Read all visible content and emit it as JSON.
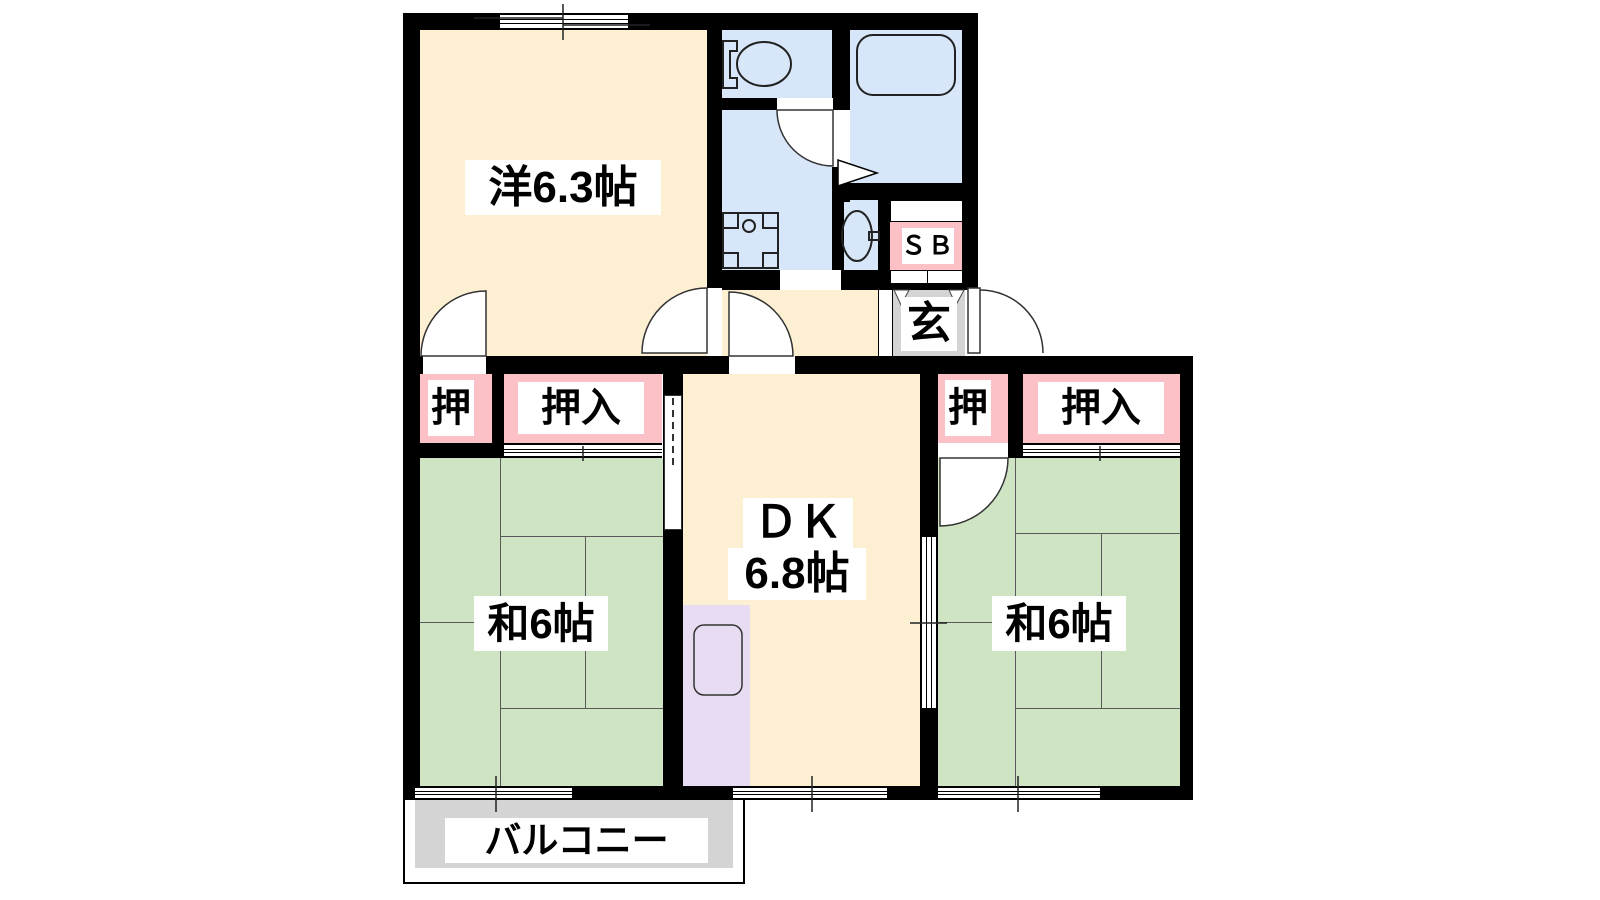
{
  "floorplan": {
    "type": "japanese-apartment-2dk",
    "rooms": {
      "western_room": {
        "label": "洋6.3帖",
        "color": "#FCEFD2"
      },
      "dining_kitchen": {
        "label_top": "ＤＫ",
        "label_bottom": "6.8帖",
        "color": "#FCEFD2"
      },
      "japanese_room_left": {
        "label": "和6帖",
        "color": "#CFE4C2"
      },
      "japanese_room_right": {
        "label": "和6帖",
        "color": "#CFE4C2"
      },
      "balcony": {
        "label": "バルコニー",
        "color": "#D4D4D4"
      },
      "entrance": {
        "label": "玄",
        "color": "#D4D4D4"
      },
      "shoe_box": {
        "label": "ＳＢ",
        "color": "#FBC1C6"
      },
      "closet_compact_left": {
        "label": "押",
        "color": "#FBC1C6"
      },
      "closet_left": {
        "label": "押入",
        "color": "#FBC1C6"
      },
      "closet_compact_right": {
        "label": "押",
        "color": "#FBC1C6"
      },
      "closet_right": {
        "label": "押入",
        "color": "#FBC1C6"
      },
      "toilet": {
        "color": "#D7E6F9"
      },
      "washroom": {
        "color": "#D7E6F9"
      },
      "bathroom": {
        "color": "#D7E6F9"
      },
      "washbasin_nook": {
        "color": "#D7E6F9"
      }
    },
    "colors": {
      "wall": "#000000",
      "room_cream": "#FCEFD2",
      "tatami_green": "#CFE4C2",
      "wet_area_blue": "#D7E6F9",
      "closet_pink": "#FBC1C6",
      "appliance_purple": "#E7DCF2",
      "entrance_gray": "#D4D4D4"
    },
    "fixtures": [
      "toilet-icon",
      "bathtub-icon",
      "washing-machine-pan-icon",
      "washbasin-icon",
      "refrigerator-icon"
    ]
  }
}
